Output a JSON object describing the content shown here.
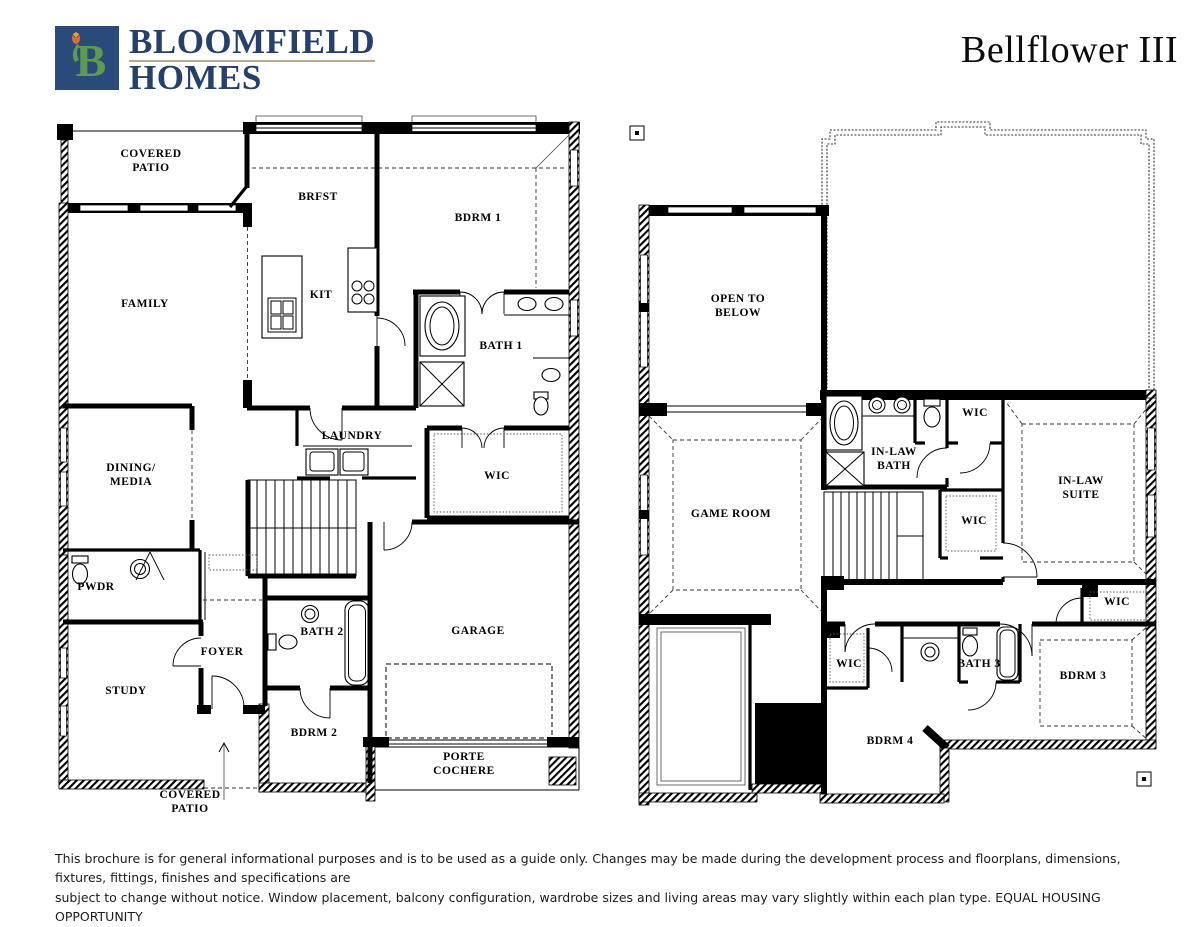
{
  "page": {
    "title": "Bellflower III"
  },
  "brand": {
    "name_line1": "BLOOMFIELD",
    "name_line2": "HOMES",
    "monogram": "B"
  },
  "colors": {
    "brand_navy": "#2b4a7c",
    "brand_green": "#5d9b4e",
    "brand_tulip": "#e06a2b",
    "brand_text_navy": "#26406e",
    "ink": "#000000"
  },
  "plans": {
    "first_floor": {
      "rooms": [
        {
          "label": "COVERED\nPATIO"
        },
        {
          "label": "BRFST"
        },
        {
          "label": "BDRM 1"
        },
        {
          "label": "FAMILY"
        },
        {
          "label": "KIT"
        },
        {
          "label": "BATH 1"
        },
        {
          "label": "LAUNDRY"
        },
        {
          "label": "DINING/\nMEDIA"
        },
        {
          "label": "WIC"
        },
        {
          "label": "PWDR"
        },
        {
          "label": "BATH 2"
        },
        {
          "label": "GARAGE"
        },
        {
          "label": "FOYER"
        },
        {
          "label": "STUDY"
        },
        {
          "label": "BDRM 2"
        },
        {
          "label": "PORTE\nCOCHERE"
        },
        {
          "label": "COVERED\nPATIO"
        }
      ]
    },
    "second_floor": {
      "rooms": [
        {
          "label": "OPEN TO\nBELOW"
        },
        {
          "label": "GAME ROOM"
        },
        {
          "label": "IN-LAW\nBATH"
        },
        {
          "label": "WIC"
        },
        {
          "label": "IN-LAW\nSUITE"
        },
        {
          "label": "WIC"
        },
        {
          "label": "WIC"
        },
        {
          "label": "WIC"
        },
        {
          "label": "BATH 3"
        },
        {
          "label": "BDRM 3"
        },
        {
          "label": "BDRM 4"
        }
      ]
    }
  },
  "footer": {
    "line1": "This brochure is for general informational purposes and is to be used as a guide only. Changes may be made during the development process and floorplans, dimensions, fixtures, fittings, finishes and specifications are",
    "line2": "subject to change without notice. Window placement, balcony configuration, wardrobe sizes and living areas may vary slightly within each plan type.  EQUAL HOUSING OPPORTUNITY"
  }
}
